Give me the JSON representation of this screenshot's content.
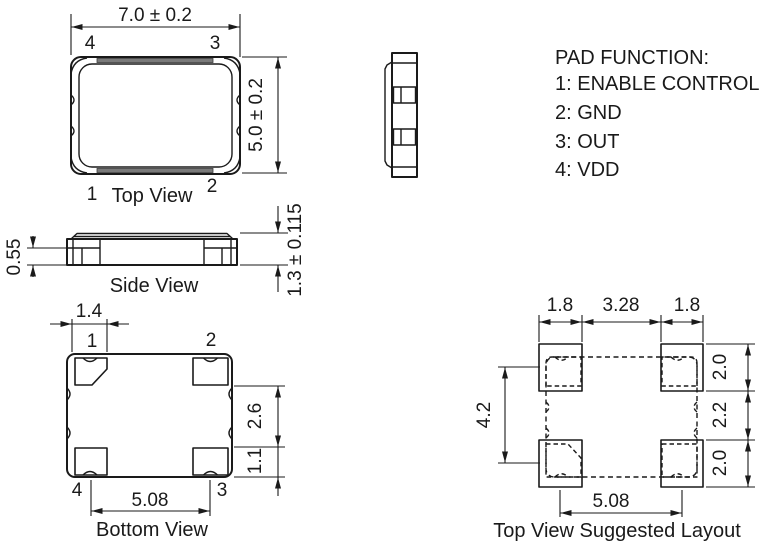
{
  "views": {
    "top": {
      "label": "Top View",
      "width_dim": "7.0 ± 0.2",
      "height_dim": "5.0 ± 0.2",
      "pin_tl": "4",
      "pin_tr": "3",
      "pin_bl": "1",
      "pin_br": "2"
    },
    "side": {
      "label": "Side View",
      "pad_height_dim": "0.55",
      "total_height_dim": "1.3 ± 0.115"
    },
    "bottom": {
      "label": "Bottom View",
      "pad_width_dim": "1.4",
      "pad_gap_dim": "2.6",
      "pad_height_dim": "1.1",
      "pad_pitch_dim": "5.08",
      "pin_tl": "1",
      "pin_tr": "2",
      "pin_bl": "4",
      "pin_br": "3"
    },
    "layout": {
      "label": "Top View Suggested Layout",
      "pad_width_left_dim": "1.8",
      "pad_gap_h_dim": "3.28",
      "pad_width_right_dim": "1.8",
      "pad_height_top_dim": "2.0",
      "pad_gap_v_dim": "2.2",
      "pad_height_bottom_dim": "2.0",
      "pad_span_v_dim": "4.2",
      "pad_pitch_dim": "5.08"
    }
  },
  "pad_function": {
    "title": "PAD FUNCTION:",
    "items": [
      "1: ENABLE CONTROL",
      "2: GND",
      "3: OUT",
      "4: VDD"
    ]
  },
  "colors": {
    "line": "#1a1a1a",
    "lid_gray": "#7a7a7a",
    "background": "#ffffff"
  }
}
